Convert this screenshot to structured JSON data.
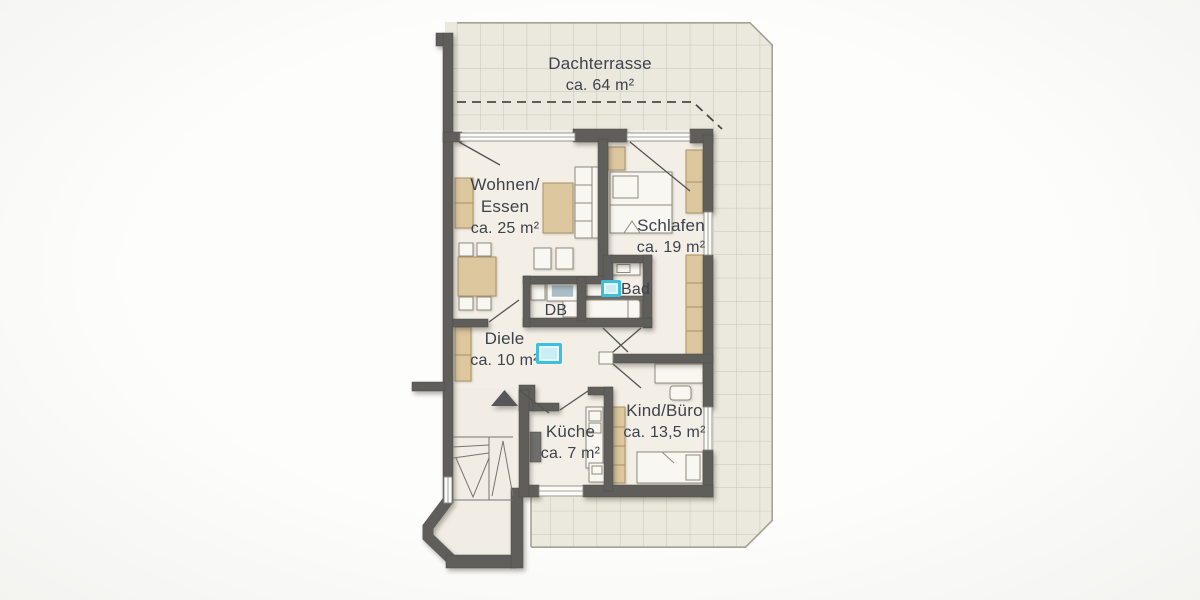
{
  "labels": {
    "dachterrasse": {
      "name": "Dachterrasse",
      "area": "ca. 64 m²"
    },
    "wohnen_essen": {
      "name_line1": "Wohnen/",
      "name_line2": "Essen",
      "area": "ca. 25 m²"
    },
    "schlafen": {
      "name": "Schlafen",
      "area": "ca. 19 m²"
    },
    "bad": {
      "name": "Bad"
    },
    "db": {
      "name": "DB"
    },
    "diele": {
      "name": "Diele",
      "area": "ca. 10 m²"
    },
    "kueche": {
      "name": "Küche",
      "area": "ca. 7 m²"
    },
    "kind_buero": {
      "name": "Kind/Büro",
      "area": "ca. 13,5 m²"
    }
  },
  "colors": {
    "wall": "#5f5e5a",
    "floor": "#f3efe7",
    "terrace_tile": "#ebe8dd",
    "tile_line": "#c9c5b6",
    "stair_floor": "#f1ede4",
    "wood": "#dcc79f",
    "wood_border": "#ab9166",
    "white_furniture": "#f9f7f1",
    "furniture_border": "#8f8a7d",
    "shower": "#a9bfc7",
    "tall_unit": "#6f6e6a",
    "highlight_border": "#3cc0de",
    "highlight_fill": "#c9eef7",
    "label": "#3e424c",
    "outline": "#a5a193",
    "dark_line": "#55544f"
  }
}
